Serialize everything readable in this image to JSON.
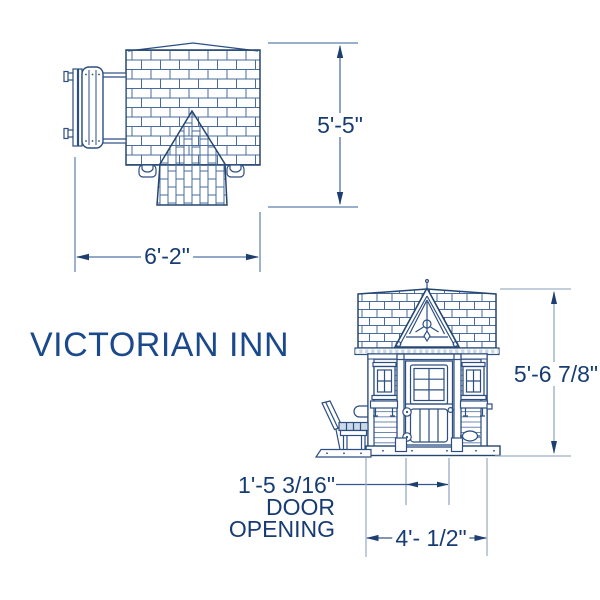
{
  "title": "VICTORIAN INN",
  "colors": {
    "line_navy": "#2c4e80",
    "line_dark": "#24466f",
    "shingle_line": "#4a6b9d",
    "dim_line_light": "#9db1c7",
    "dim_line_medium": "#5d7fae",
    "arrow_navy": "#1d3e6f",
    "text_navy": "#173c74",
    "title_blue": "#1b4a8c",
    "background": "#ffffff"
  },
  "top_view": {
    "depth_dimension": "5'-5\"",
    "width_dimension": "6'-2\""
  },
  "front_view": {
    "height_dimension": "5'-6 7/8\"",
    "width_dimension": "4'- 1/2\"",
    "door_opening_dimension": "1'-5 3/16\"",
    "door_opening_label_line1": "DOOR",
    "door_opening_label_line2": "OPENING"
  }
}
